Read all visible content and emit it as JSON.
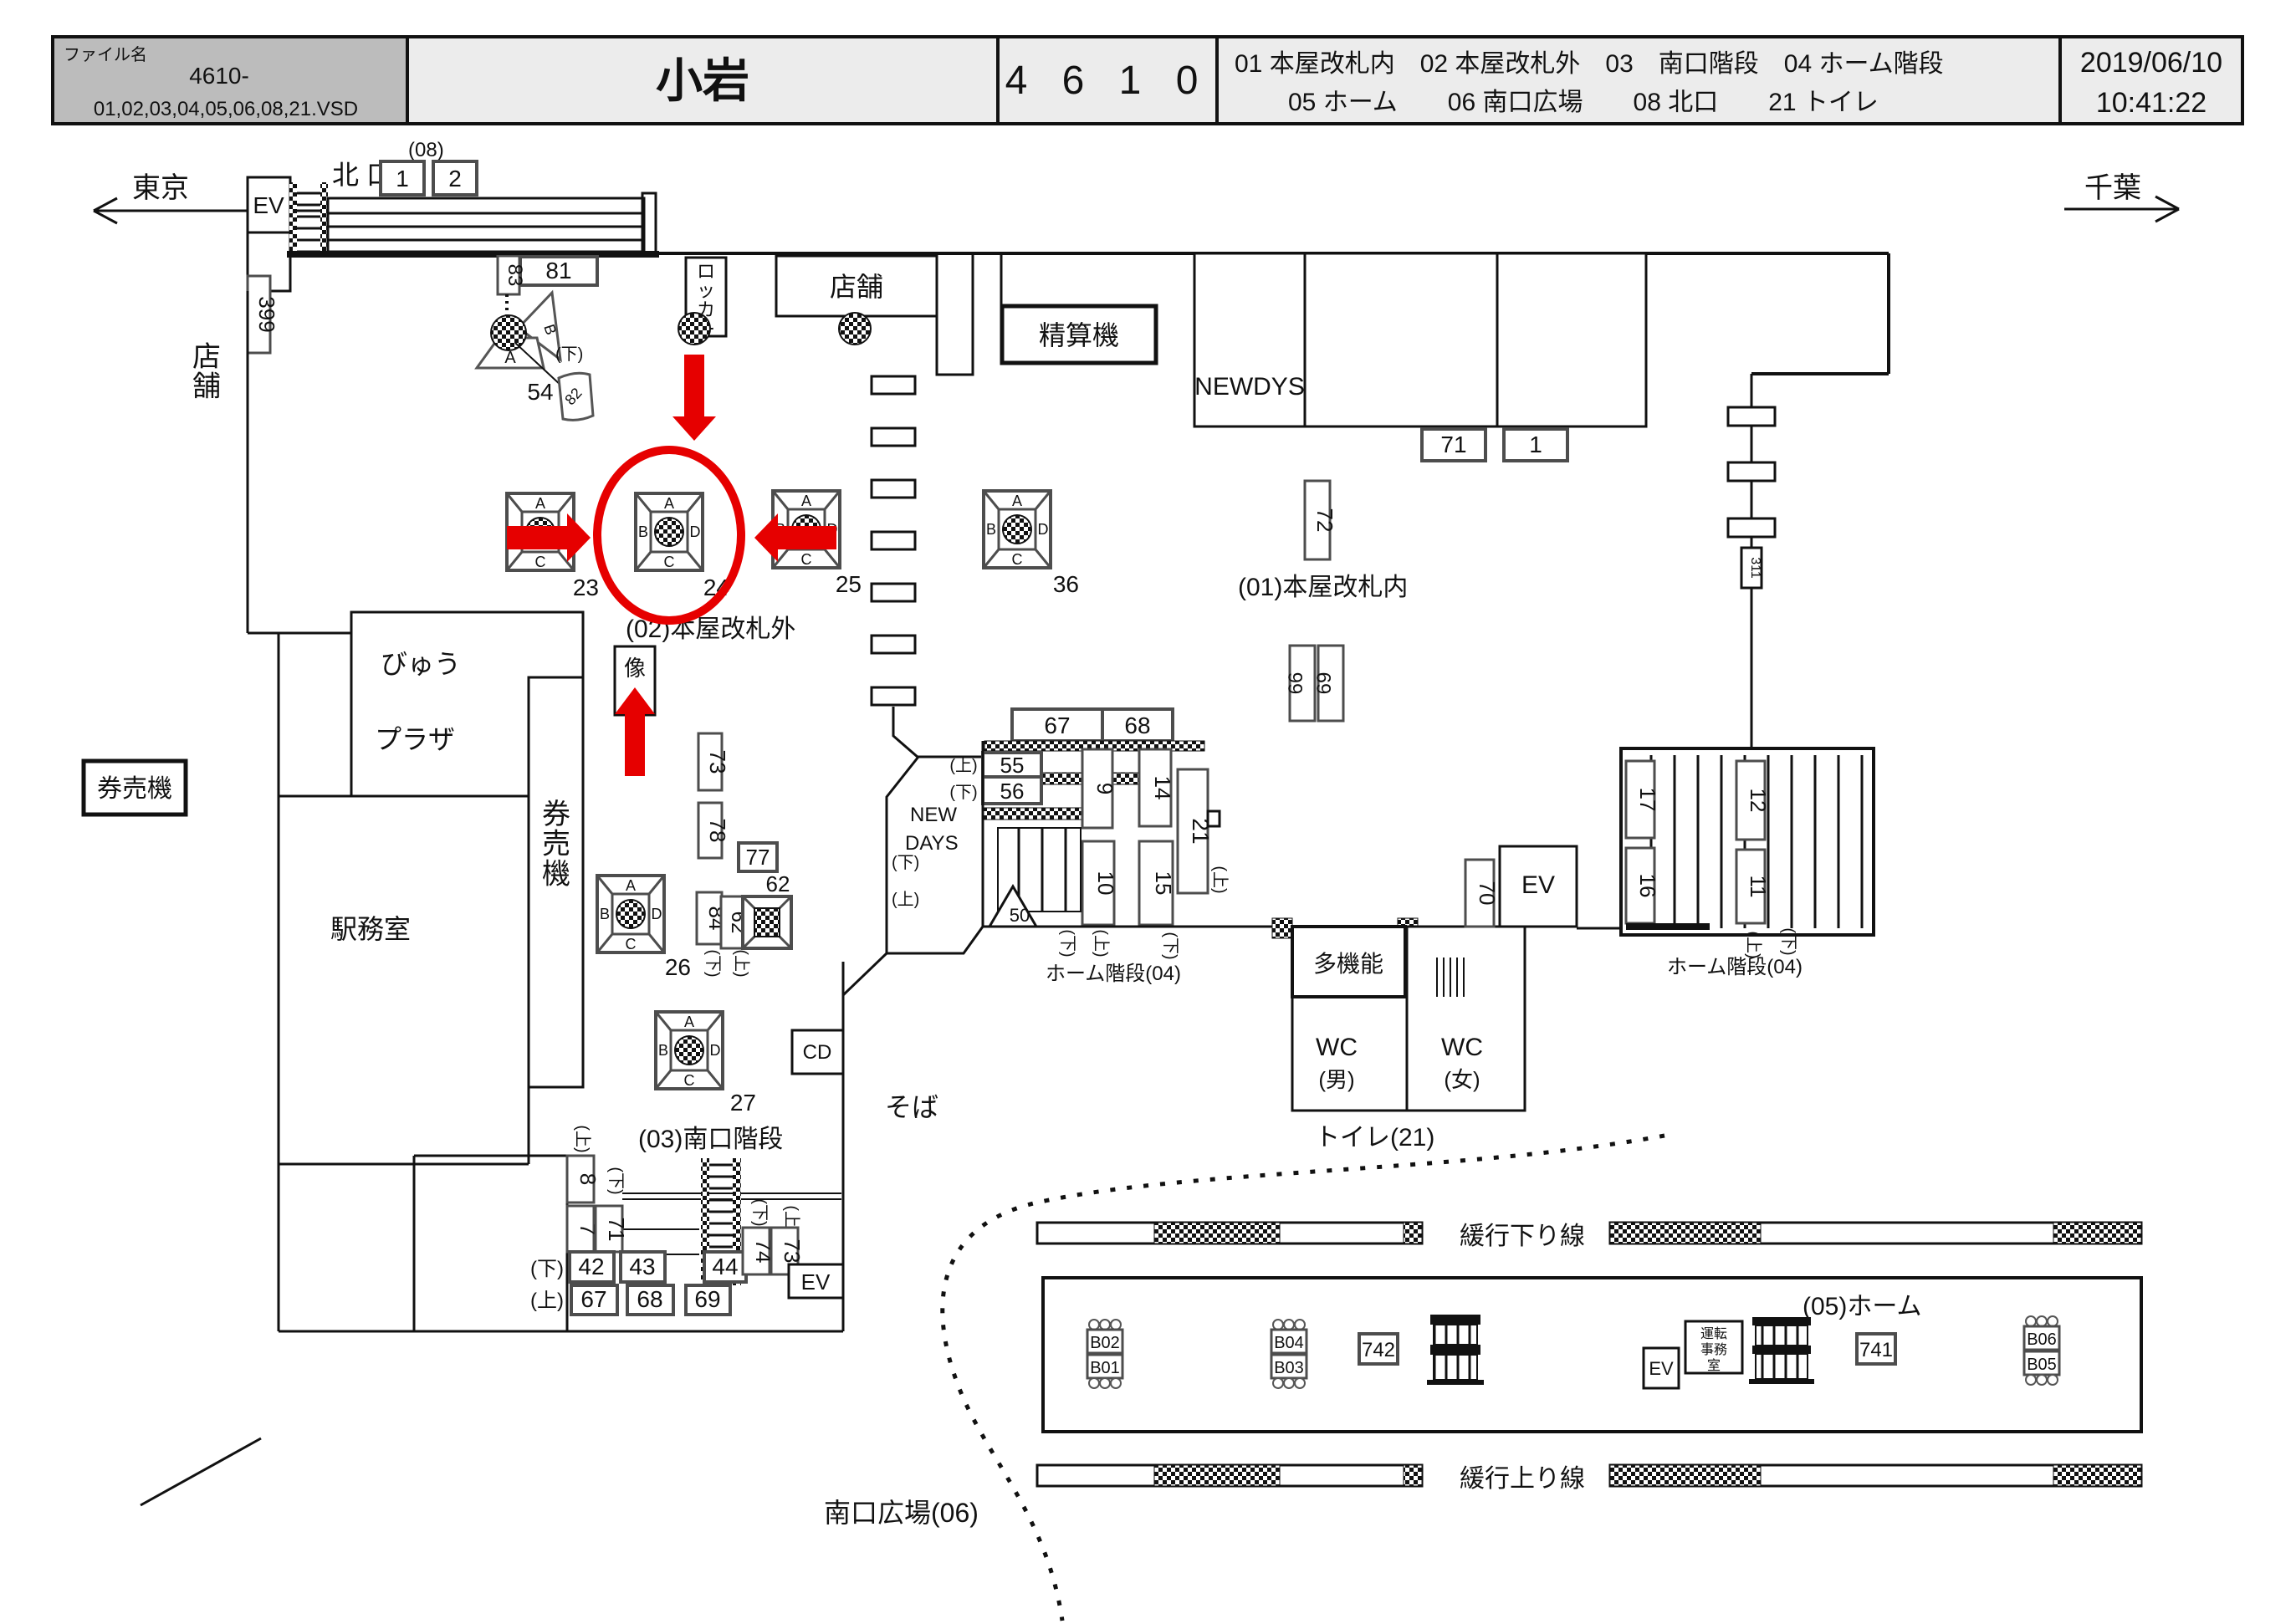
{
  "colors": {
    "red": "#e60000",
    "header_gray": "#bcbcbc",
    "header_light": "#ececec",
    "line": "#111111",
    "ad_box_border": "#4d4d4d"
  },
  "header": {
    "file_label": "ファイル名",
    "file_line1": "4610-",
    "file_line2": "01,02,03,04,05,06,08,21.VSD",
    "station": "小岩",
    "sheet_no": "4 6 1 0",
    "legend_line1": "01 本屋改札内　02 本屋改札外　03　南口階段　04 ホーム階段",
    "legend_line2": "05 ホーム　　06 南口広場　　08 北口　　21 トイレ",
    "date": "2019/06/10",
    "time": "10:41:22"
  },
  "directions": {
    "west": "東京",
    "east": "千葉"
  },
  "misc": {
    "a": "A",
    "b": "B",
    "c": "C",
    "d": "D",
    "up": "(上)",
    "down": "(下)",
    "ev": "EV"
  },
  "north": {
    "exit": "北 口",
    "code": "(08)",
    "box1": "1",
    "box2": "2",
    "n399": "399",
    "shop_vert": "店舗",
    "n81": "81",
    "n83": "83",
    "locker": "ロッカー",
    "p54_num": "54",
    "p54_n82": "82",
    "shop": "店舗",
    "fare_adjust": "精算機"
  },
  "rooms": {
    "newdys": "NEWDYS",
    "n71": "71",
    "n1": "1",
    "n72": "72",
    "area01": "(01)本屋改札内",
    "n66": "66",
    "n69": "69",
    "n311": "311"
  },
  "pillars": {
    "p23": "23",
    "p24": "24",
    "p25": "25",
    "p36": "36",
    "p26": "26",
    "p27": "27"
  },
  "area02": {
    "label": "(02)本屋改札外",
    "statue": "像",
    "n73": "73",
    "n78": "78",
    "n77": "77",
    "n84": "84",
    "n62": "62"
  },
  "west_rooms": {
    "ticket_sign": "券売機",
    "plaza1": "びゅう",
    "plaza2": "プラザ",
    "ticket_vert": "券売機",
    "office": "駅務室"
  },
  "south": {
    "label": "(03)南口階段",
    "n8": "8",
    "n7": "7",
    "n71": "71",
    "n42": "42",
    "n43": "43",
    "n44": "44",
    "n67": "67",
    "n68": "68",
    "n69": "69",
    "n74": "74",
    "n73": "73",
    "cd": "CD",
    "soba": "そば",
    "plaza": "南口広場(06)"
  },
  "center": {
    "n67": "67",
    "n68": "68",
    "n55": "55",
    "n56": "56",
    "n9": "9",
    "n14": "14",
    "n21": "21",
    "n10": "10",
    "n15": "15",
    "n50": "50",
    "newdays1": "NEW",
    "newdays2": "DAYS",
    "stair_label": "ホーム階段(04)"
  },
  "toilet": {
    "multi": "多機能",
    "wc": "WC",
    "men": "(男)",
    "women": "(女)",
    "label": "トイレ(21)",
    "n70": "70"
  },
  "east_stairs": {
    "n17": "17",
    "n16": "16",
    "n12": "12",
    "n11": "11",
    "label": "ホーム階段(04)"
  },
  "platform": {
    "label": "(05)ホーム",
    "b02": "B02",
    "b01": "B01",
    "b04": "B04",
    "b03": "B03",
    "n742": "742",
    "ops1": "運転",
    "ops2": "事務",
    "ops3": "室",
    "n741": "741",
    "b06": "B06",
    "b05": "B05",
    "down_line": "緩行下り線",
    "up_line": "緩行上り線"
  }
}
